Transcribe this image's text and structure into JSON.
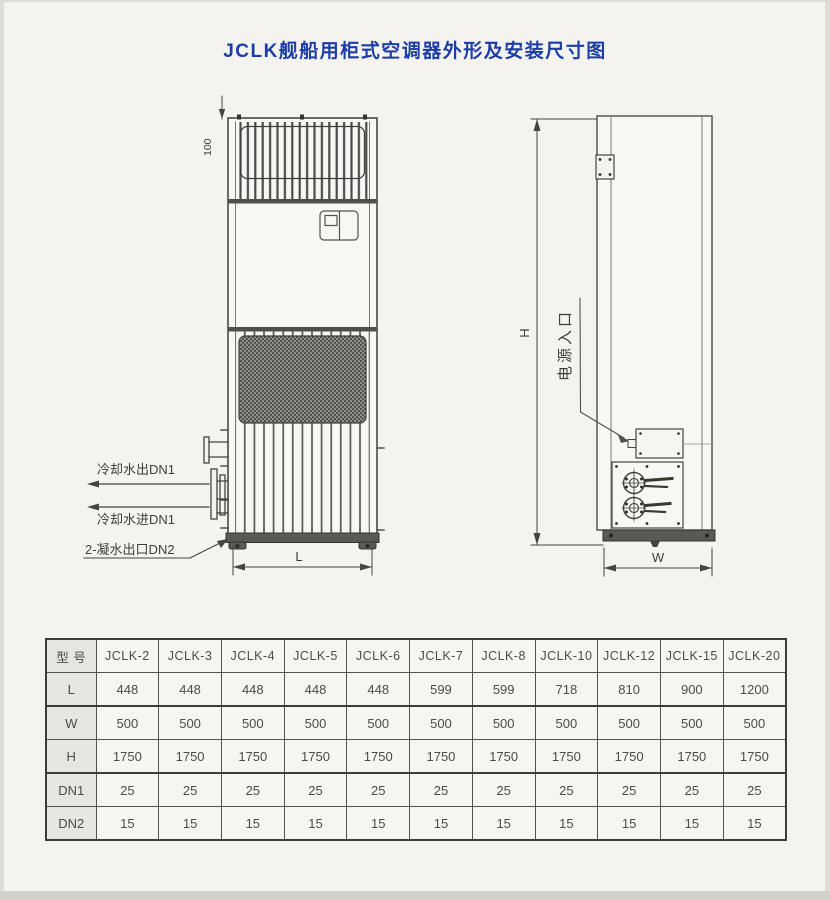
{
  "page": {
    "title": "JCLK舰船用柜式空调器外形及安装尺寸图"
  },
  "front_view": {
    "labels": {
      "top_clearance": "100",
      "cooling_water_out": "冷却水出DN1",
      "cooling_water_in": "冷却水进DN1",
      "condensate_out": "2-凝水出口DN2",
      "length_dim": "L"
    }
  },
  "side_view": {
    "labels": {
      "power_inlet": "电源入口",
      "height_dim": "H",
      "width_dim": "W"
    }
  },
  "table": {
    "header": [
      "型 号",
      "JCLK-2",
      "JCLK-3",
      "JCLK-4",
      "JCLK-5",
      "JCLK-6",
      "JCLK-7",
      "JCLK-8",
      "JCLK-10",
      "JCLK-12",
      "JCLK-15",
      "JCLK-20"
    ],
    "rows": [
      {
        "label": "L",
        "values": [
          "448",
          "448",
          "448",
          "448",
          "448",
          "599",
          "599",
          "718",
          "810",
          "900",
          "1200"
        ]
      },
      {
        "label": "W",
        "values": [
          "500",
          "500",
          "500",
          "500",
          "500",
          "500",
          "500",
          "500",
          "500",
          "500",
          "500"
        ]
      },
      {
        "label": "H",
        "values": [
          "1750",
          "1750",
          "1750",
          "1750",
          "1750",
          "1750",
          "1750",
          "1750",
          "1750",
          "1750",
          "1750"
        ]
      },
      {
        "label": "DN1",
        "values": [
          "25",
          "25",
          "25",
          "25",
          "25",
          "25",
          "25",
          "25",
          "25",
          "25",
          "25"
        ]
      },
      {
        "label": "DN2",
        "values": [
          "15",
          "15",
          "15",
          "15",
          "15",
          "15",
          "15",
          "15",
          "15",
          "15",
          "15"
        ]
      }
    ]
  }
}
